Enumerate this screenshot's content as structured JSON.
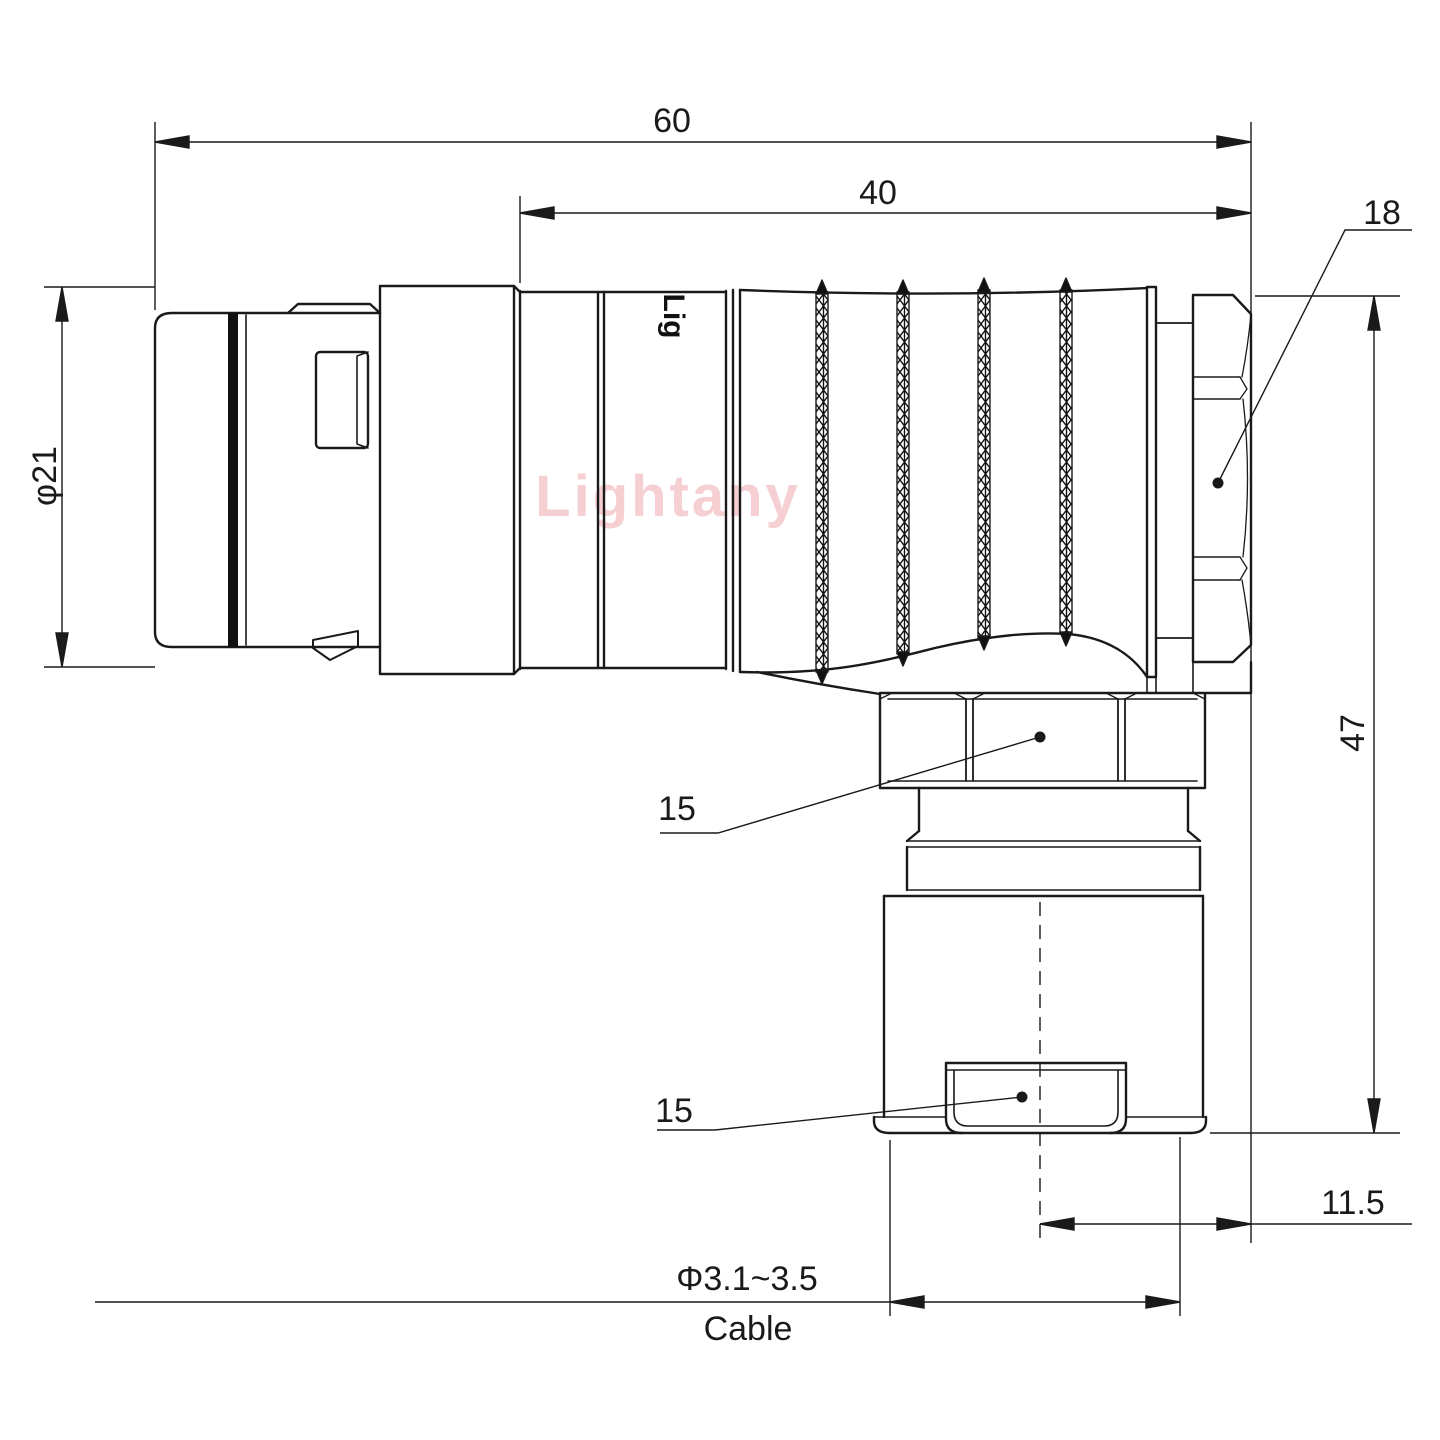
{
  "page": {
    "background": "#ffffff"
  },
  "style": {
    "line_color": "#1a1a1a",
    "watermark_color": "#f4cacd"
  },
  "watermark": {
    "text": "Lightany"
  },
  "body_print": {
    "text": "Lig"
  },
  "dims": {
    "overall_length": "60",
    "body_length": "40",
    "backnut_width": "18",
    "front_diameter": "φ21",
    "total_height": "47",
    "coupling_nut": "15",
    "cable_clamp": "15",
    "axis_offset": "11.5",
    "cable_range": "Φ3.1~3.5",
    "cable_word": "Cable"
  }
}
